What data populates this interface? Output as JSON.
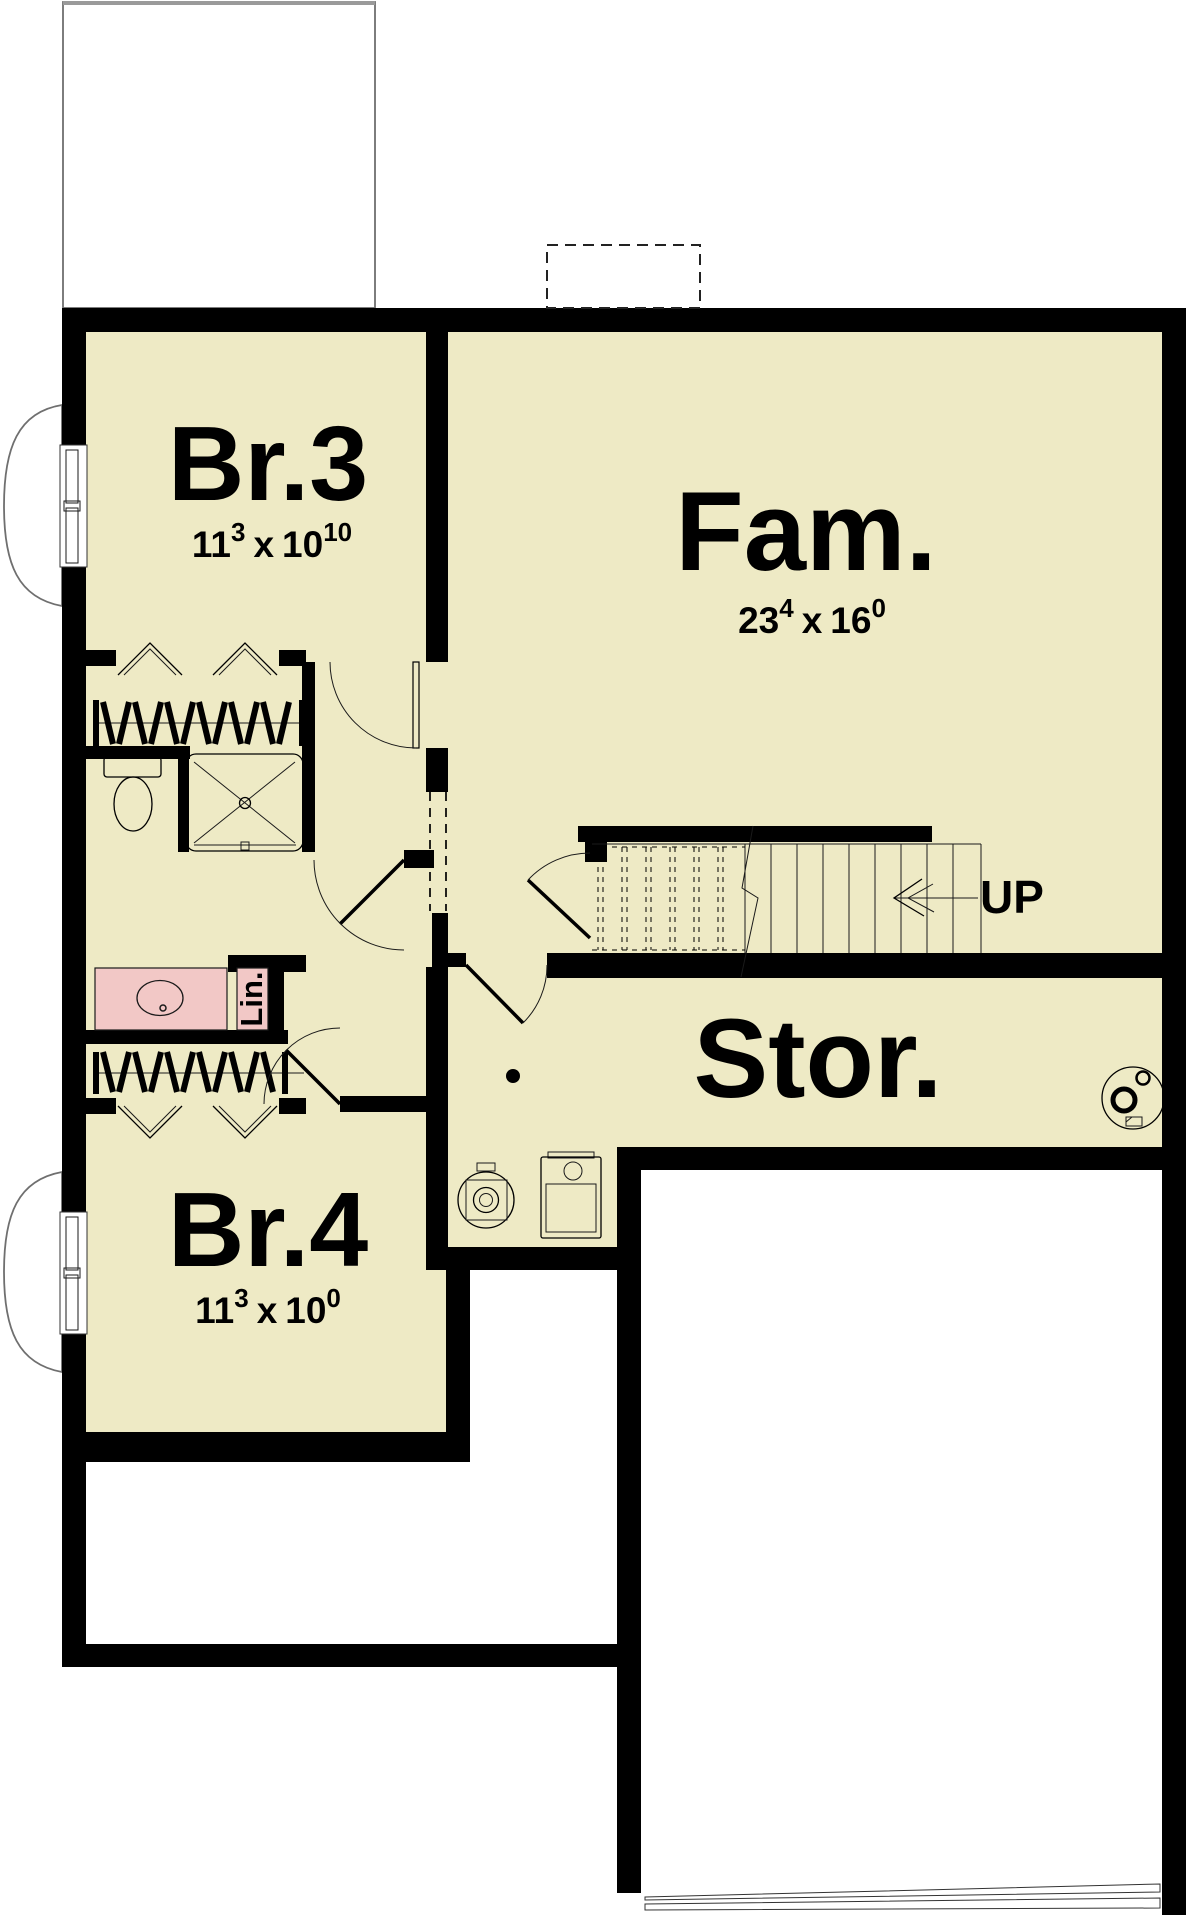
{
  "plan_labels": {
    "br3": {
      "name": "Br.3",
      "dim": {
        "w": "11",
        "w_in": "3",
        "sep": "x",
        "h": "10",
        "h_in": "10"
      }
    },
    "fam": {
      "name": "Fam.",
      "dim": {
        "w": "23",
        "w_in": "4",
        "sep": "x",
        "h": "16",
        "h_in": "0"
      }
    },
    "stor": {
      "name": "Stor."
    },
    "br4": {
      "name": "Br.4",
      "dim": {
        "w": "11",
        "w_in": "3",
        "sep": "x",
        "h": "10",
        "h_in": "0"
      }
    },
    "linen": {
      "name": "Lin."
    },
    "stairs": {
      "direction": "UP"
    }
  },
  "colors": {
    "floor": "#eeeac5",
    "wall": "#000000",
    "fixture_highlight": "#f2c8c6",
    "outline_gray": "#6f6f6f",
    "paper": "#ffffff"
  }
}
